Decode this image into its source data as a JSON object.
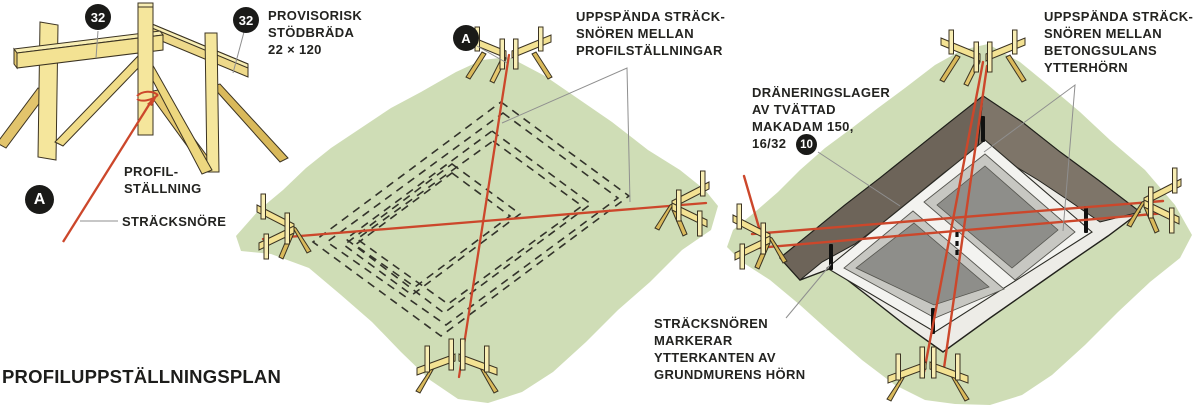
{
  "figure": {
    "title": "PROFILUPPSTÄLLNINGSPLAN",
    "language": "sv"
  },
  "badges": {
    "board_left": "32",
    "board_right": "32",
    "profile_detail_left": "A",
    "profile_detail_mid": "A",
    "drainage_ref": "10"
  },
  "labels": {
    "provisorisk": "PROVISORISK\nSTÖDBRÄDA\n22 × 120",
    "profilstallning": "PROFIL-\nSTÄLLNING",
    "stracksnore": "STRÄCKSNÖRE",
    "mid_strings": "UPPSPÄNDA STRÄCK-\nSNÖREN MELLAN\nPROFILSTÄLLNINGAR",
    "draneringslager": "DRÄNERINGSLAGER\nAV TVÄTTAD\nMAKADAM 150,\n16/32",
    "right_strings": "UPPSPÄNDA STRÄCK-\nSNÖREN MELLAN\nBETONGSULANS\nYTTERHÖRN",
    "stracksnoren_markerar": "STRÄCKSNÖREN\nMARKERAR\nYTTERKANTEN AV\nGRUNDMURENS HÖRN"
  },
  "colors": {
    "string_red": "#cc472b",
    "ground_green": "#cfddb6",
    "wood_face": "#f3e293",
    "excavation_wall": "#6d6459",
    "gravel": "#edece7",
    "text": "#232320"
  }
}
